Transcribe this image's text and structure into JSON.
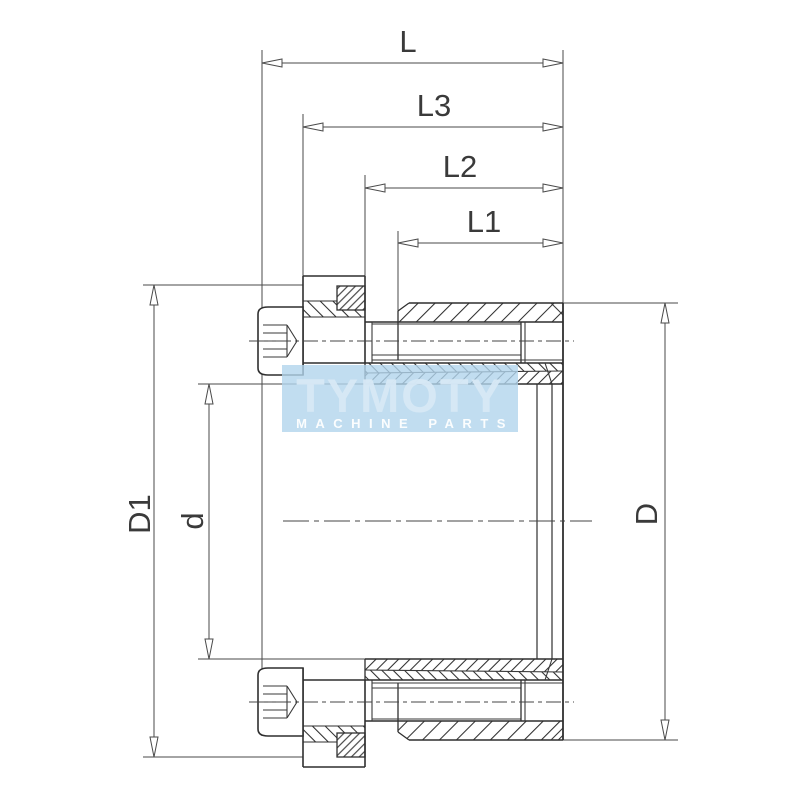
{
  "drawing": {
    "type": "technical-section-drawing",
    "subject": "keyless shaft locking assembly cross-section",
    "background_color": "#ffffff",
    "line_color": "#2f2f2f",
    "dimension_color": "#4a4a4a"
  },
  "dims": {
    "L": {
      "label": "L"
    },
    "L3": {
      "label": "L3"
    },
    "L2": {
      "label": "L2"
    },
    "L1": {
      "label": "L1"
    },
    "D1": {
      "label": "D1"
    },
    "d": {
      "label": "d"
    },
    "D": {
      "label": "D"
    }
  },
  "watermark": {
    "brand": "TYMOTY",
    "subtitle": "MACHINE PARTS",
    "box_color": "#b2d5ec",
    "brand_color": "#d8e9f6",
    "subtitle_color": "#ffffff"
  }
}
